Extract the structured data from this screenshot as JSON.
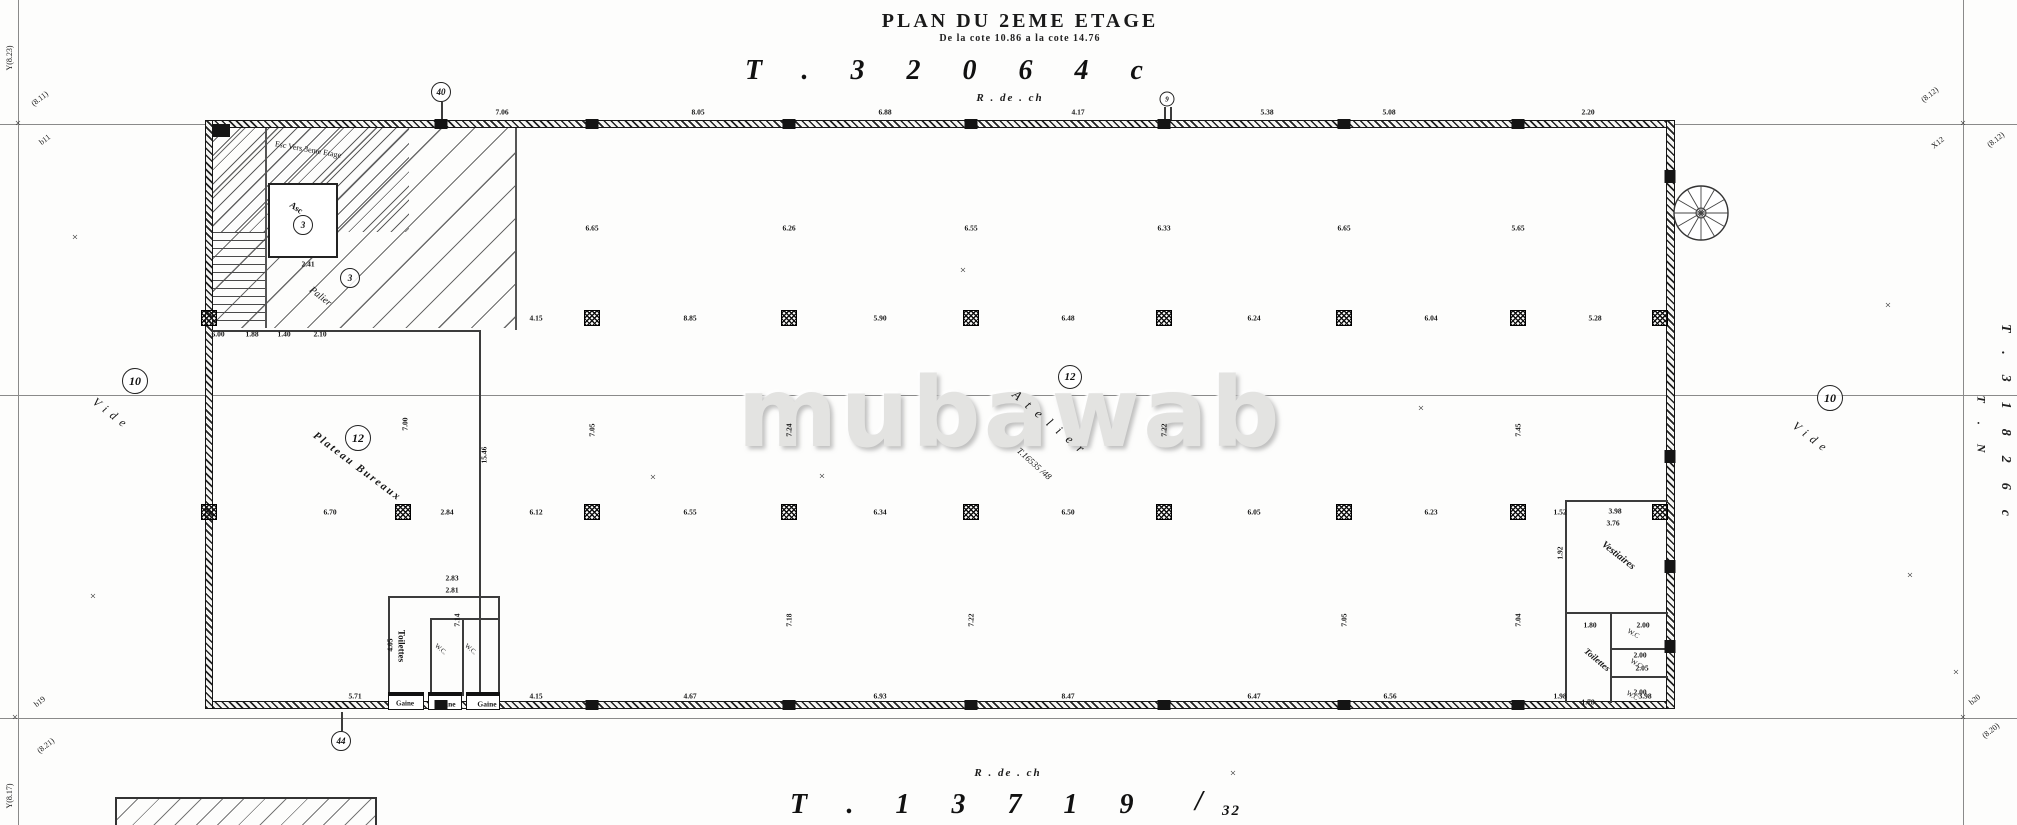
{
  "header": {
    "title": "PLAN DU 2EME ETAGE",
    "subtitle": "De la cote 10.86 a la cote 14.76",
    "code": "T.32064c",
    "level": "R . de . ch"
  },
  "footer": {
    "level": "R . de . ch",
    "code": "T.13719",
    "slash": "/",
    "sheet": "32"
  },
  "watermark": {
    "text": "mubawab"
  },
  "side_refs": {
    "right_code": "T.31826c",
    "right_axis": "T . N"
  },
  "plan": {
    "xmark_char": "×",
    "labels": [
      {
        "t": "Vide",
        "x": 112,
        "y": 414,
        "r": 38,
        "fs": 12,
        "ls": 6,
        "i": 1
      },
      {
        "t": "Vide",
        "x": 1812,
        "y": 438,
        "r": 38,
        "fs": 12,
        "ls": 6,
        "i": 1
      },
      {
        "t": "Atelier",
        "x": 1052,
        "y": 424,
        "r": 40,
        "fs": 13,
        "ls": 9,
        "i": 1
      },
      {
        "t": "T.16535 /48",
        "x": 1034,
        "y": 464,
        "r": 42,
        "fs": 9,
        "i": 1
      },
      {
        "t": "Plateau Bureaux",
        "x": 357,
        "y": 467,
        "r": 37,
        "fs": 11,
        "ls": 2,
        "i": 1,
        "b": 1
      },
      {
        "t": "Palier",
        "x": 320,
        "y": 297,
        "r": 38,
        "fs": 10,
        "i": 1
      },
      {
        "t": "Esc Vers 3eme Etage",
        "x": 308,
        "y": 150,
        "r": 10,
        "fs": 8
      },
      {
        "t": "Asc",
        "x": 296,
        "y": 208,
        "r": 35,
        "fs": 9,
        "b": 1
      },
      {
        "t": "Vestiaires",
        "x": 1618,
        "y": 556,
        "r": 38,
        "fs": 10,
        "i": 1,
        "b": 1
      },
      {
        "t": "Toilettes",
        "x": 1597,
        "y": 660,
        "r": 40,
        "fs": 9,
        "i": 1,
        "b": 1
      },
      {
        "t": "W.C",
        "x": 1633,
        "y": 634,
        "r": 30,
        "fs": 7
      },
      {
        "t": "W.C",
        "x": 1636,
        "y": 664,
        "r": 30,
        "fs": 7
      },
      {
        "t": "W.C",
        "x": 1632,
        "y": 696,
        "r": 30,
        "fs": 7
      },
      {
        "t": "Toilettes",
        "x": 401,
        "y": 646,
        "r": 90,
        "fs": 9,
        "b": 1
      },
      {
        "t": "W.C.",
        "x": 440,
        "y": 650,
        "r": 40,
        "fs": 6.5
      },
      {
        "t": "W.C.",
        "x": 470,
        "y": 650,
        "r": 40,
        "fs": 6.5
      },
      {
        "t": "Gaine",
        "x": 405,
        "y": 704,
        "fs": 7,
        "b": 1
      },
      {
        "t": "Gaine",
        "x": 446,
        "y": 704,
        "fs": 7.5,
        "b": 1
      },
      {
        "t": "Gaine",
        "x": 487,
        "y": 704,
        "fs": 7.5,
        "b": 1
      },
      {
        "t": "(8.11)",
        "x": 40,
        "y": 99,
        "r": -38,
        "fs": 8
      },
      {
        "t": "b11",
        "x": 45,
        "y": 140,
        "r": -38,
        "fs": 8
      },
      {
        "t": "Y(8.23)",
        "x": 10,
        "y": 58,
        "r": -90,
        "fs": 8
      },
      {
        "t": "(8.12)",
        "x": 1930,
        "y": 95,
        "r": -38,
        "fs": 8
      },
      {
        "t": "X12",
        "x": 1938,
        "y": 143,
        "r": -38,
        "fs": 8
      },
      {
        "t": "(8.12)",
        "x": 1996,
        "y": 140,
        "r": -38,
        "fs": 8
      },
      {
        "t": "b19",
        "x": 40,
        "y": 702,
        "r": -38,
        "fs": 8
      },
      {
        "t": "(8.21)",
        "x": 46,
        "y": 746,
        "r": -38,
        "fs": 8
      },
      {
        "t": "Y(8.17)",
        "x": 10,
        "y": 796,
        "r": -90,
        "fs": 8
      },
      {
        "t": "b20",
        "x": 1975,
        "y": 700,
        "r": -38,
        "fs": 8
      },
      {
        "t": "(8.20)",
        "x": 1991,
        "y": 731,
        "r": -38,
        "fs": 8
      }
    ],
    "dimensions": [
      {
        "t": "7.06",
        "x": 502,
        "y": 112
      },
      {
        "t": "8.05",
        "x": 698,
        "y": 112
      },
      {
        "t": "6.88",
        "x": 885,
        "y": 112
      },
      {
        "t": "4.17",
        "x": 1078,
        "y": 112
      },
      {
        "t": "5.38",
        "x": 1267,
        "y": 112
      },
      {
        "t": "5.08",
        "x": 1389,
        "y": 112
      },
      {
        "t": "2.20",
        "x": 1588,
        "y": 112
      },
      {
        "t": "6.65",
        "x": 592,
        "y": 228
      },
      {
        "t": "6.26",
        "x": 789,
        "y": 228
      },
      {
        "t": "6.55",
        "x": 971,
        "y": 228
      },
      {
        "t": "6.33",
        "x": 1164,
        "y": 228
      },
      {
        "t": "6.65",
        "x": 1344,
        "y": 228
      },
      {
        "t": "5.65",
        "x": 1518,
        "y": 228
      },
      {
        "t": "4.15",
        "x": 536,
        "y": 318
      },
      {
        "t": "8.85",
        "x": 690,
        "y": 318
      },
      {
        "t": "5.90",
        "x": 880,
        "y": 318
      },
      {
        "t": "6.48",
        "x": 1068,
        "y": 318
      },
      {
        "t": "6.24",
        "x": 1254,
        "y": 318
      },
      {
        "t": "6.04",
        "x": 1431,
        "y": 318
      },
      {
        "t": "5.28",
        "x": 1595,
        "y": 318
      },
      {
        "t": "6.70",
        "x": 330,
        "y": 512
      },
      {
        "t": "2.84",
        "x": 447,
        "y": 512
      },
      {
        "t": "6.12",
        "x": 536,
        "y": 512
      },
      {
        "t": "6.55",
        "x": 690,
        "y": 512
      },
      {
        "t": "6.34",
        "x": 880,
        "y": 512
      },
      {
        "t": "6.50",
        "x": 1068,
        "y": 512
      },
      {
        "t": "6.05",
        "x": 1254,
        "y": 512
      },
      {
        "t": "6.23",
        "x": 1431,
        "y": 512
      },
      {
        "t": "1.52",
        "x": 1560,
        "y": 512
      },
      {
        "t": "7.00",
        "x": 405,
        "y": 424,
        "r": -90
      },
      {
        "t": "7.05",
        "x": 592,
        "y": 430,
        "r": -90
      },
      {
        "t": "7.24",
        "x": 789,
        "y": 430,
        "r": -90
      },
      {
        "t": "7.22",
        "x": 1164,
        "y": 430,
        "r": -90
      },
      {
        "t": "7.45",
        "x": 1518,
        "y": 430,
        "r": -90
      },
      {
        "t": "15.46",
        "x": 484,
        "y": 455,
        "r": -90
      },
      {
        "t": "7.14",
        "x": 457,
        "y": 620,
        "r": -90
      },
      {
        "t": "7.18",
        "x": 789,
        "y": 620,
        "r": -90
      },
      {
        "t": "7.22",
        "x": 971,
        "y": 620,
        "r": -90
      },
      {
        "t": "7.05",
        "x": 1344,
        "y": 620,
        "r": -90
      },
      {
        "t": "7.04",
        "x": 1518,
        "y": 620,
        "r": -90
      },
      {
        "t": "5.71",
        "x": 355,
        "y": 696
      },
      {
        "t": "4.15",
        "x": 536,
        "y": 696
      },
      {
        "t": "4.67",
        "x": 690,
        "y": 696
      },
      {
        "t": "6.93",
        "x": 880,
        "y": 696
      },
      {
        "t": "8.47",
        "x": 1068,
        "y": 696
      },
      {
        "t": "6.47",
        "x": 1254,
        "y": 696
      },
      {
        "t": "6.56",
        "x": 1390,
        "y": 696
      },
      {
        "t": "1.98",
        "x": 1560,
        "y": 696
      },
      {
        "t": "3.98",
        "x": 1645,
        "y": 696
      },
      {
        "t": "6.00",
        "x": 218,
        "y": 334
      },
      {
        "t": "1.88",
        "x": 252,
        "y": 334
      },
      {
        "t": "1.40",
        "x": 284,
        "y": 334
      },
      {
        "t": "2.10",
        "x": 320,
        "y": 334
      },
      {
        "t": "2.41",
        "x": 308,
        "y": 264
      },
      {
        "t": "2.83",
        "x": 452,
        "y": 578
      },
      {
        "t": "2.81",
        "x": 452,
        "y": 590
      },
      {
        "t": "4.05",
        "x": 390,
        "y": 645,
        "r": -90
      },
      {
        "t": "3.98",
        "x": 1615,
        "y": 511
      },
      {
        "t": "3.76",
        "x": 1613,
        "y": 523
      },
      {
        "t": "1.92",
        "x": 1560,
        "y": 553,
        "r": -90
      },
      {
        "t": "1.80",
        "x": 1590,
        "y": 625
      },
      {
        "t": "2.00",
        "x": 1643,
        "y": 625
      },
      {
        "t": "2.00",
        "x": 1640,
        "y": 655
      },
      {
        "t": "2.05",
        "x": 1642,
        "y": 668
      },
      {
        "t": "2.00",
        "x": 1640,
        "y": 692
      },
      {
        "t": "1.78",
        "x": 1588,
        "y": 702
      }
    ],
    "bubbles": [
      {
        "t": "10",
        "x": 135,
        "y": 381,
        "d": 26
      },
      {
        "t": "10",
        "x": 1830,
        "y": 398,
        "d": 26
      },
      {
        "t": "12",
        "x": 1070,
        "y": 377,
        "d": 24
      },
      {
        "t": "12",
        "x": 358,
        "y": 438,
        "d": 26
      },
      {
        "t": "3",
        "x": 303,
        "y": 225,
        "d": 20
      },
      {
        "t": "3",
        "x": 350,
        "y": 278,
        "d": 20
      },
      {
        "t": "40",
        "x": 441,
        "y": 92,
        "d": 20
      },
      {
        "t": "9",
        "x": 1167,
        "y": 99,
        "d": 15
      },
      {
        "t": "44",
        "x": 341,
        "y": 741,
        "d": 20
      }
    ],
    "xmarks": [
      [
        75,
        238
      ],
      [
        93,
        597
      ],
      [
        963,
        271
      ],
      [
        822,
        477
      ],
      [
        1421,
        409
      ],
      [
        653,
        478
      ],
      [
        1888,
        306
      ],
      [
        1910,
        576
      ],
      [
        1956,
        673
      ],
      [
        1233,
        774
      ],
      [
        18,
        124
      ],
      [
        1963,
        124
      ],
      [
        15,
        718
      ],
      [
        1963,
        718
      ]
    ]
  }
}
